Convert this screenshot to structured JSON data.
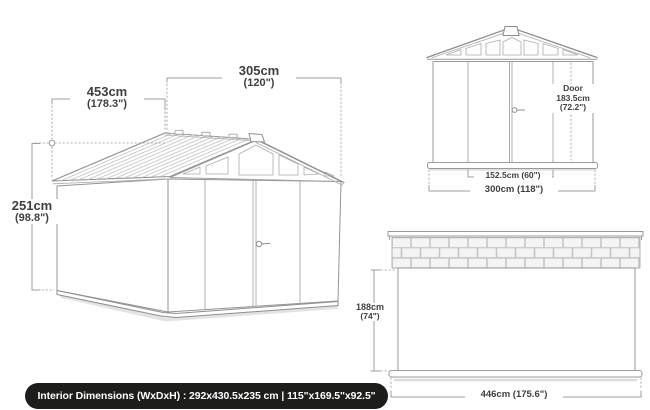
{
  "diagram": {
    "perspective": {
      "depth": {
        "cm": "453cm",
        "in": "(178.3\")"
      },
      "width": {
        "cm": "305cm",
        "in": "(120\")"
      },
      "height": {
        "cm": "251cm",
        "in": "(98.8\")"
      }
    },
    "front": {
      "door": {
        "title": "Door",
        "cm": "183.5cm",
        "in": "(72.2\")"
      },
      "door_width": "152.5cm (60\")",
      "width": "300cm (118\")"
    },
    "side": {
      "height": {
        "cm": "188cm",
        "in": "(74\")"
      },
      "depth": "446cm (175.6\")"
    },
    "footer": {
      "text": "Interior Dimensions (WxDxH) : 292x430.5x235 cm | 115\"x169.5\"x92.5\""
    },
    "colors": {
      "line": "#9a9a9a",
      "text": "#3f3f3f",
      "footer_bg": "#1d1d1b",
      "footer_text": "#ffffff"
    }
  }
}
